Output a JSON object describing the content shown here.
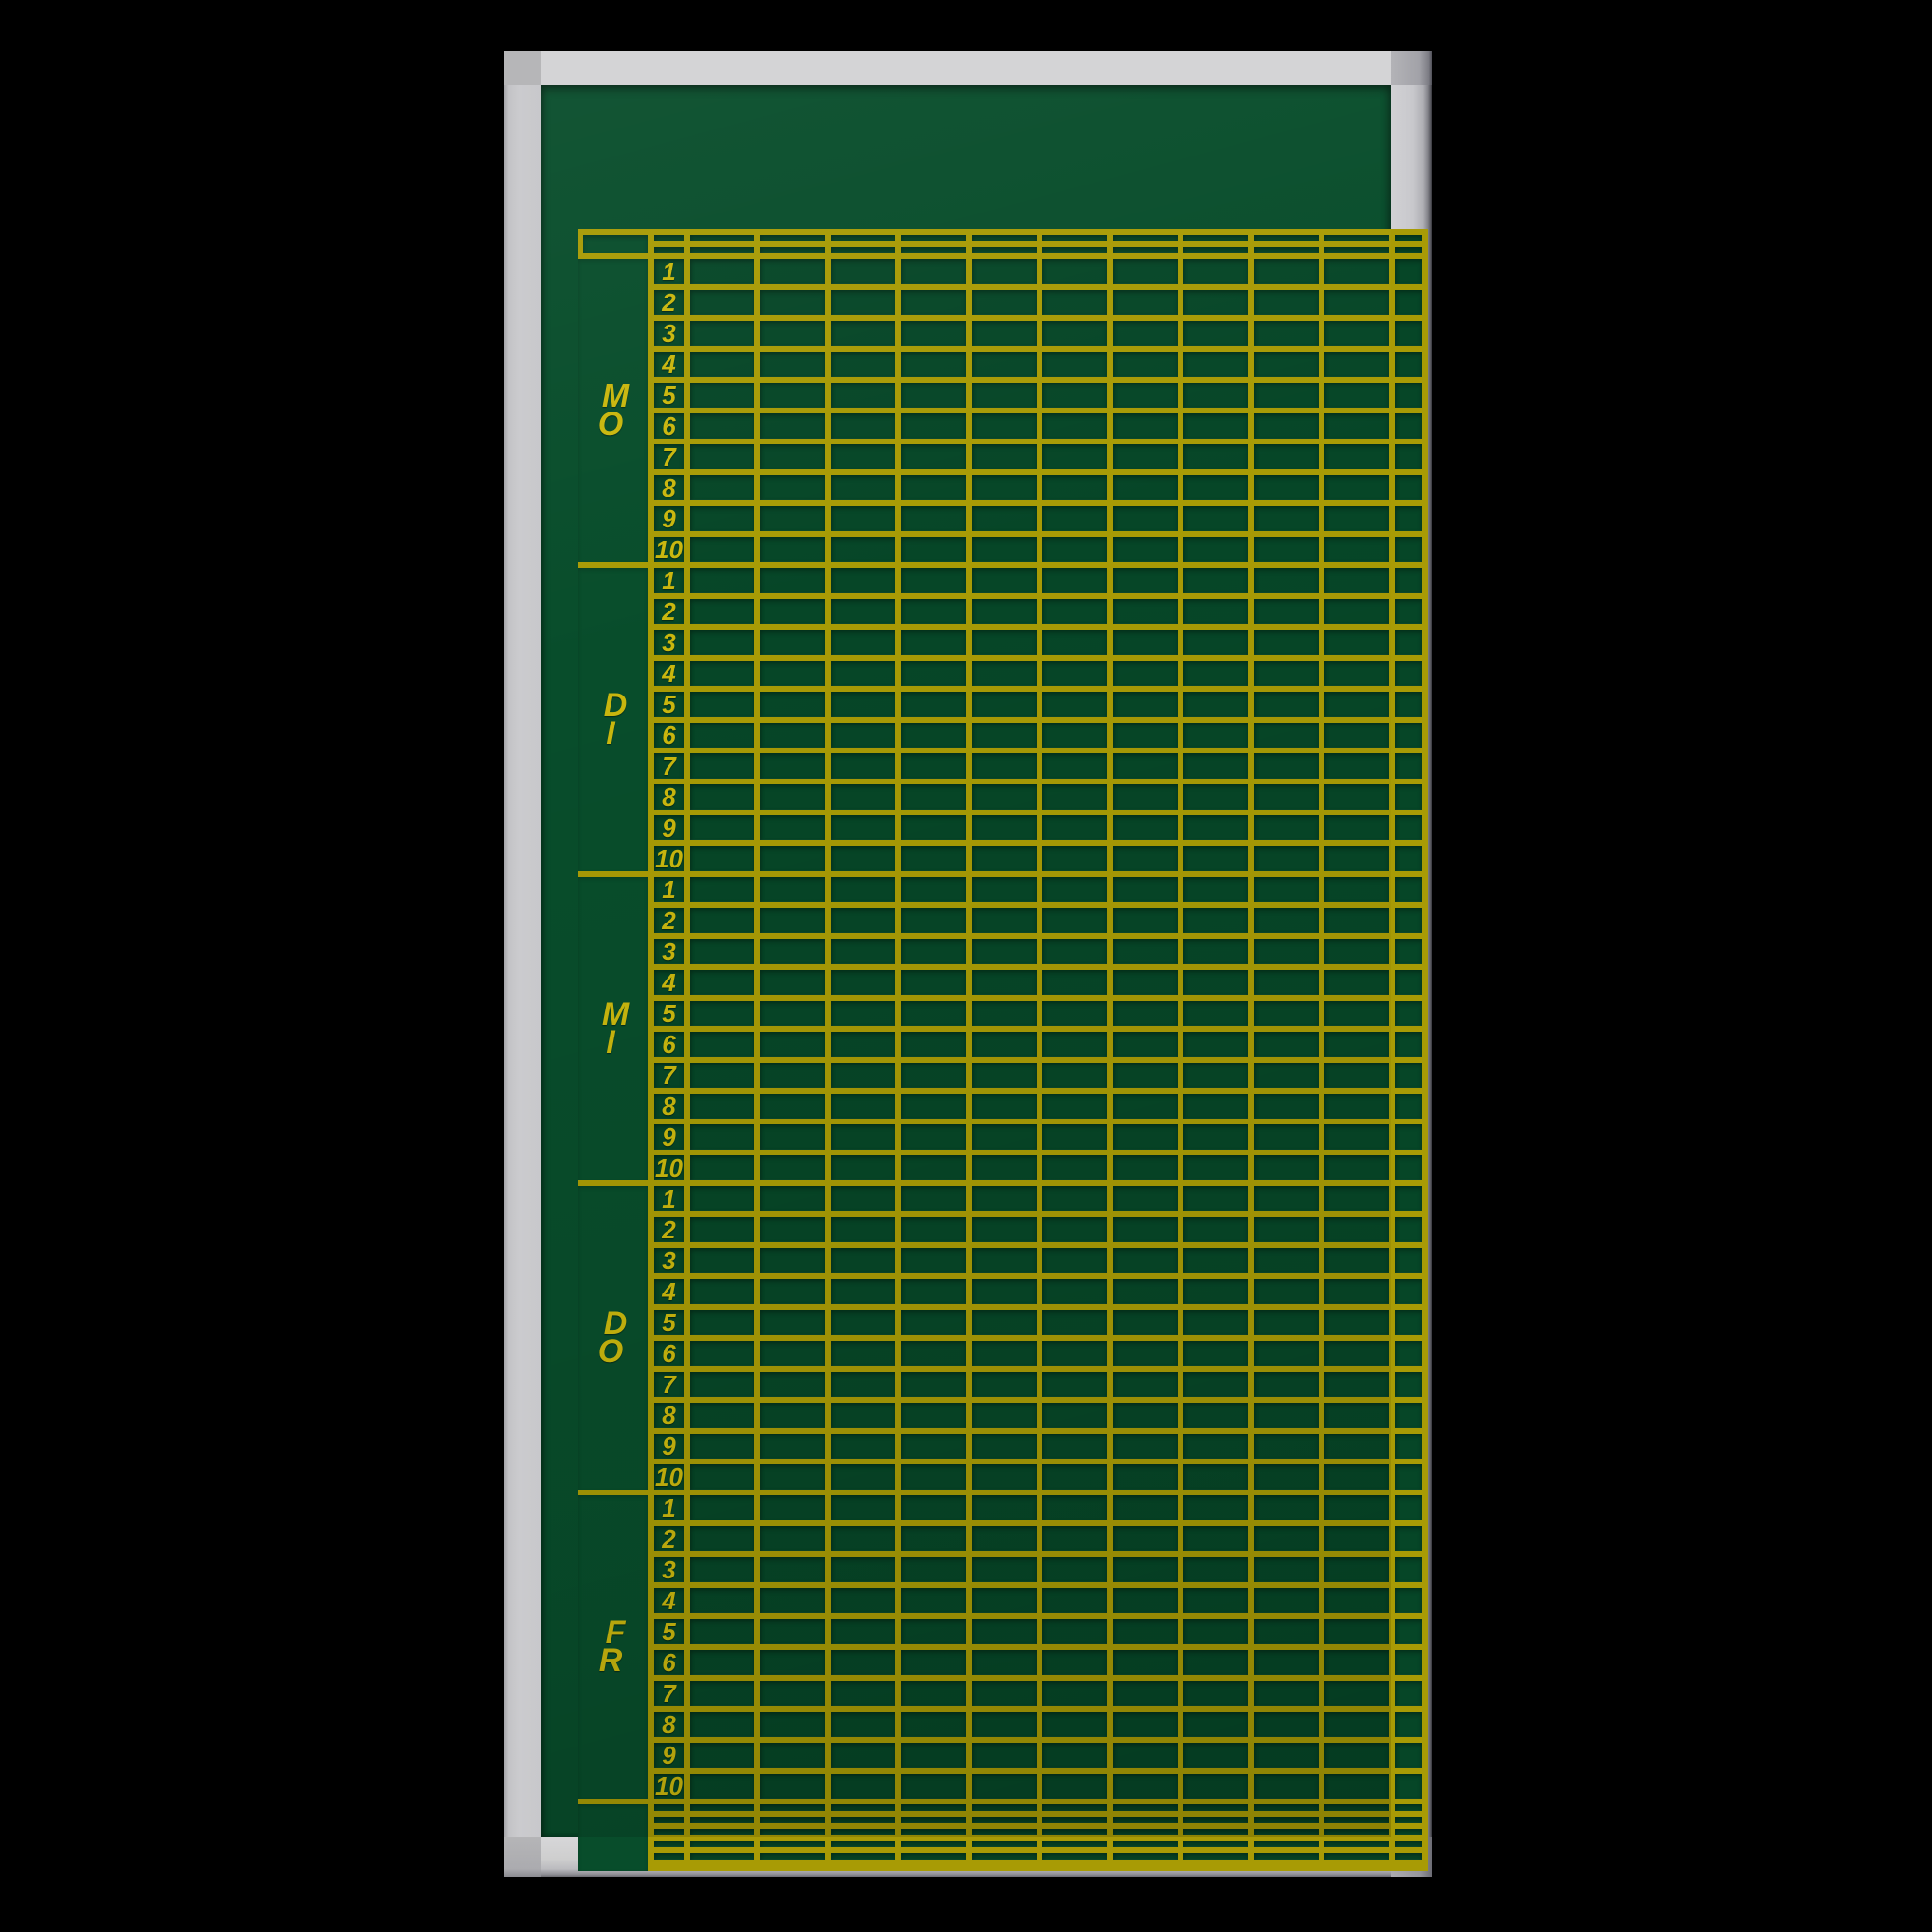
{
  "board": {
    "header_box_label": "",
    "title_band_text": ""
  },
  "days": [
    {
      "label": "MO",
      "letters": [
        "M",
        "O"
      ],
      "periods": [
        "1",
        "2",
        "3",
        "4",
        "5",
        "6",
        "7",
        "8",
        "9",
        "10"
      ]
    },
    {
      "label": "DI",
      "letters": [
        "D",
        "I"
      ],
      "periods": [
        "1",
        "2",
        "3",
        "4",
        "5",
        "6",
        "7",
        "8",
        "9",
        "10"
      ]
    },
    {
      "label": "MI",
      "letters": [
        "M",
        "I"
      ],
      "periods": [
        "1",
        "2",
        "3",
        "4",
        "5",
        "6",
        "7",
        "8",
        "9",
        "10"
      ]
    },
    {
      "label": "DO",
      "letters": [
        "D",
        "O"
      ],
      "periods": [
        "1",
        "2",
        "3",
        "4",
        "5",
        "6",
        "7",
        "8",
        "9",
        "10"
      ]
    },
    {
      "label": "FR",
      "letters": [
        "F",
        "R"
      ],
      "periods": [
        "1",
        "2",
        "3",
        "4",
        "5",
        "6",
        "7",
        "8",
        "9",
        "10"
      ]
    }
  ],
  "grid": {
    "header_rows": 2,
    "rows_per_day": 10,
    "footer_rows": 6,
    "slot_columns": 10,
    "has_narrow_end_column": true
  },
  "colors": {
    "background": "#000000",
    "surface_band_green": "#084d2b",
    "cell_green": "#064627",
    "line_yellow": "#a89b05",
    "text_yellow": "#c9b70e",
    "frame_light_gray": "#d4d4d6",
    "frame_mid_gray": "#c9c9cb",
    "frame_corner_gray": "#b6b6b8"
  }
}
